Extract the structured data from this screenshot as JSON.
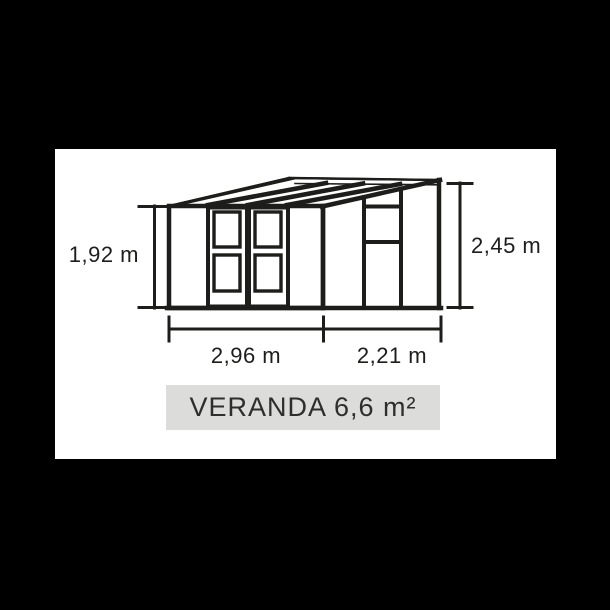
{
  "diagram": {
    "title": "VERANDA 6,6 m²",
    "dimensions": {
      "front_height": "1,92 m",
      "rear_height": "2,45 m",
      "front_width": "2,96 m",
      "side_depth": "2,21 m"
    },
    "colors": {
      "page_background": "#000000",
      "drawing_background": "#ffffff",
      "line": "#1d1d1b",
      "title_box_background": "#dcdcda",
      "title_text": "#2e2e2c"
    }
  }
}
